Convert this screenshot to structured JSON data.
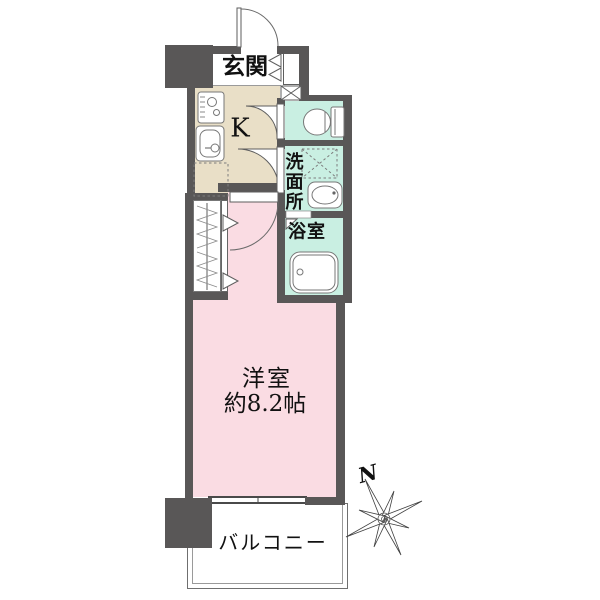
{
  "labels": {
    "genkan": "玄関",
    "kitchen": "K",
    "washroom": "洗面所",
    "bath": "浴室",
    "room_name": "洋室",
    "room_size": "約8.2帖",
    "balcony": "バルコニー",
    "compass_north": "N"
  },
  "colors": {
    "wall": "#595757",
    "kitchen": "#e9dfc7",
    "wet": "#c9efe2",
    "room": "#fadce3",
    "line": "#4a4a4a",
    "fixture": "#777777",
    "white": "#ffffff"
  },
  "icons": {
    "entrance_door": "entrance-door-swing-icon",
    "shoe_cabinet": "shoe-cabinet-bifold-icon",
    "pipe_space": "pipe-space-x-icon",
    "toilet": "toilet-icon",
    "stove": "gas-stove-icon",
    "kitchen_sink": "kitchen-sink-icon",
    "refrigerator_space": "refrigerator-space-icon",
    "washing_machine_space": "washing-machine-space-icon",
    "wash_basin": "wash-basin-icon",
    "bathtub": "bathtub-icon",
    "closet_hanger": "hanger-pipe-icon",
    "compass": "compass-star-icon"
  }
}
